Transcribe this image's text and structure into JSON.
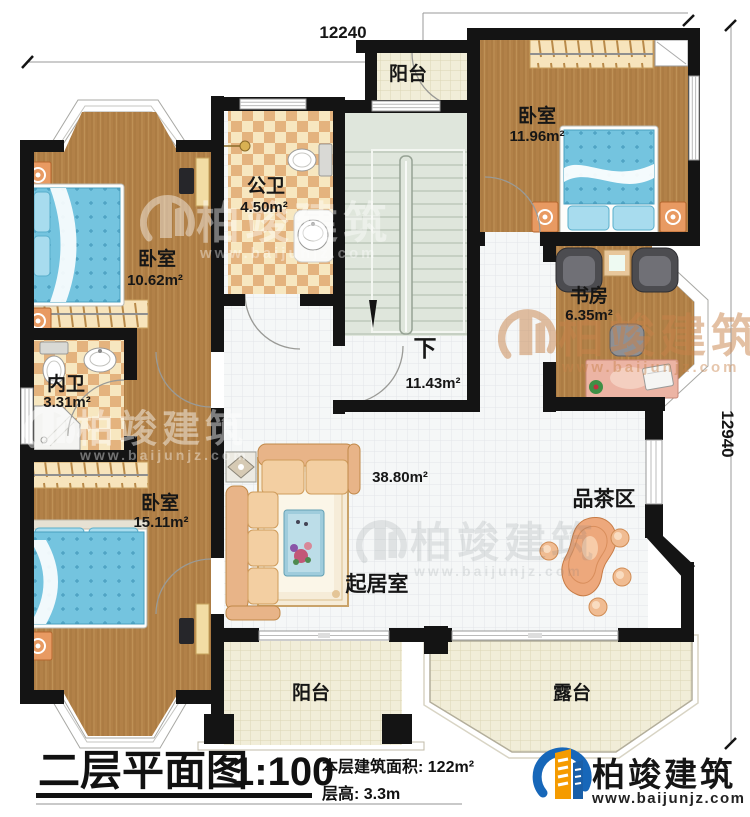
{
  "dimensions": {
    "top": "12240",
    "right": "12940"
  },
  "rooms": {
    "balcony_top": {
      "name": "阳台"
    },
    "bedroom_top_right": {
      "name": "卧室",
      "area": "11.96m²"
    },
    "public_bathroom": {
      "name": "公卫",
      "area": "4.50m²"
    },
    "bedroom_top_left": {
      "name": "卧室",
      "area": "10.62m²"
    },
    "study": {
      "name": "书房",
      "area": "6.35m²"
    },
    "stairwell": {
      "name": "下",
      "area": "11.43m²"
    },
    "inner_bathroom": {
      "name": "内卫",
      "area": "3.31m²"
    },
    "bedroom_bottom_left": {
      "name": "卧室",
      "area": "15.11m²"
    },
    "living_room": {
      "name": "起居室",
      "area": "38.80m²"
    },
    "tea_area": {
      "name": "品茶区"
    },
    "balcony_bottom": {
      "name": "阳台"
    },
    "terrace": {
      "name": "露台"
    }
  },
  "title": {
    "main": "二层平面图",
    "scale": "1:100"
  },
  "stats": {
    "floor_area": "本层建筑面积: 122m²",
    "floor_height": "层高: 3.3m"
  },
  "brand": {
    "name": "柏竣建筑",
    "website": "www.baijunjz.com"
  },
  "watermark": {
    "name": "柏竣建筑",
    "website": "www.baijunjz.com"
  },
  "colors": {
    "wall": "#141414",
    "wood": "#b28148",
    "checker_light": "#f7e7c0",
    "checker_dark": "#e4b37e",
    "stairs": "#dfe6dc",
    "tile": "#f5f7f7",
    "outdoor_tile": "#f1edd8",
    "bed": "#74c4df",
    "brand_blue": "#1767b9",
    "brand_orange": "#f59b00"
  }
}
